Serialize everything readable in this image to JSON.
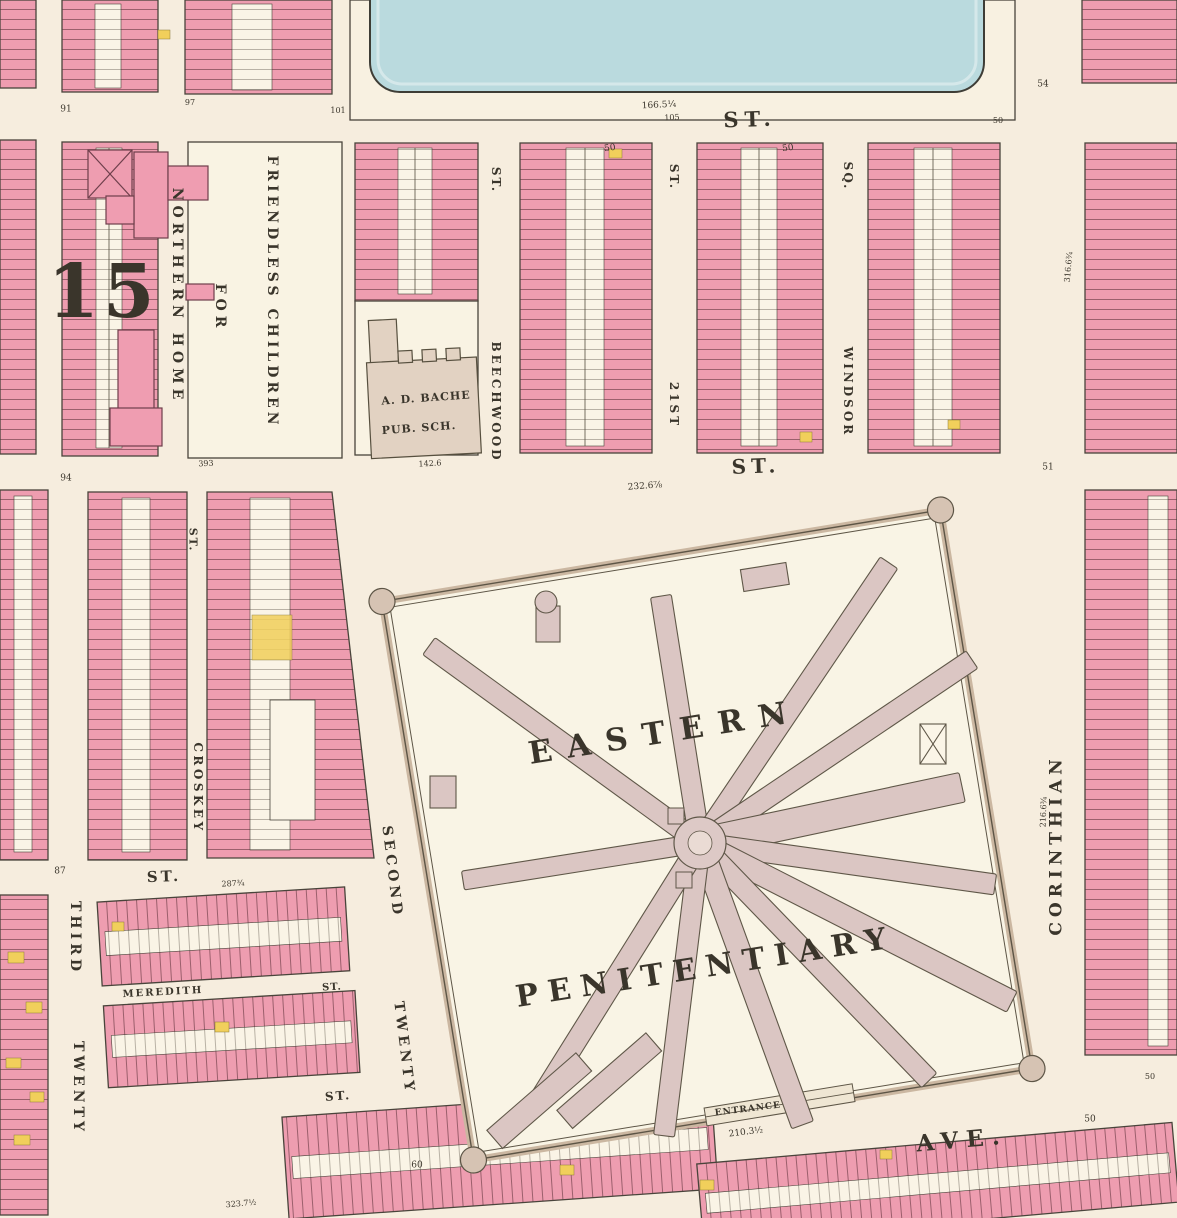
{
  "map": {
    "sheet_type": "property-atlas-plate",
    "plate_number": "15",
    "colors": {
      "paper": "#f6edde",
      "block_ground": "#f8f1e1",
      "house_pink": "#ee9db0",
      "house_white": "#faf4e6",
      "house_yellow": "#f1cf5b",
      "water": "#badade",
      "wall_tan": "#cbb7a1",
      "wing_mauve": "#dbc6c3",
      "outline": "#49443b",
      "ink": "#3a352b"
    },
    "labels": [
      {
        "n": "plate-number",
        "t": "15",
        "x": 103,
        "y": 292,
        "r": 0,
        "s": 74,
        "ls": 4,
        "w": 700
      },
      {
        "n": "street-st-top",
        "t": "ST.",
        "x": 750,
        "y": 119,
        "r": -2,
        "s": 21,
        "ls": 6,
        "w": 700
      },
      {
        "n": "dim-top-1",
        "t": "166.5¼",
        "x": 659,
        "y": 106,
        "r": -3,
        "s": 9,
        "w": 400
      },
      {
        "n": "dim-top-2",
        "t": "105",
        "x": 672,
        "y": 118,
        "r": -3,
        "s": 8,
        "w": 400
      },
      {
        "n": "dim-top-3",
        "t": "50",
        "x": 998,
        "y": 121,
        "r": 0,
        "s": 8,
        "w": 400
      },
      {
        "n": "num-54",
        "t": "54",
        "x": 1043,
        "y": 85,
        "r": 0,
        "s": 9,
        "w": 400
      },
      {
        "n": "num-91",
        "t": "91",
        "x": 66,
        "y": 110,
        "r": 0,
        "s": 9,
        "w": 400
      },
      {
        "n": "num-101",
        "t": "101",
        "x": 338,
        "y": 111,
        "r": 0,
        "s": 8,
        "w": 400
      },
      {
        "n": "num-97",
        "t": "97",
        "x": 190,
        "y": 103,
        "r": 0,
        "s": 8,
        "w": 400
      },
      {
        "n": "street-beechwood-st",
        "t": "ST.",
        "x": 496,
        "y": 180,
        "r": 90,
        "s": 12,
        "ls": 2,
        "w": 700
      },
      {
        "n": "street-beechwood",
        "t": "BEECHWOOD",
        "x": 496,
        "y": 402,
        "r": 90,
        "s": 12,
        "ls": 3,
        "w": 700
      },
      {
        "n": "street-21st-st",
        "t": "ST.",
        "x": 674,
        "y": 177,
        "r": 90,
        "s": 12,
        "ls": 2,
        "w": 700
      },
      {
        "n": "street-21st",
        "t": "21ST",
        "x": 674,
        "y": 405,
        "r": 90,
        "s": 12,
        "ls": 3,
        "w": 700
      },
      {
        "n": "street-windsor-sq",
        "t": "SQ.",
        "x": 848,
        "y": 176,
        "r": 90,
        "s": 12,
        "ls": 2,
        "w": 700
      },
      {
        "n": "street-windsor",
        "t": "WINDSOR",
        "x": 848,
        "y": 392,
        "r": 90,
        "s": 12,
        "ls": 3,
        "w": 700
      },
      {
        "n": "institution-northern-home",
        "t": "NORTHERN HOME",
        "x": 177,
        "y": 296,
        "r": 90,
        "s": 14,
        "ls": 5,
        "w": 700
      },
      {
        "n": "institution-for",
        "t": "FOR",
        "x": 220,
        "y": 308,
        "r": 90,
        "s": 14,
        "ls": 5,
        "w": 700
      },
      {
        "n": "institution-friendless-children",
        "t": "FRIENDLESS CHILDREN",
        "x": 272,
        "y": 292,
        "r": 90,
        "s": 14,
        "ls": 4,
        "w": 700
      },
      {
        "n": "school-name",
        "t": "A. D. BACHE",
        "x": 426,
        "y": 398,
        "r": -4,
        "s": 11,
        "ls": 1,
        "w": 700
      },
      {
        "n": "school-type",
        "t": "PUB. SCH.",
        "x": 419,
        "y": 428,
        "r": -4,
        "s": 11,
        "ls": 1,
        "w": 700
      },
      {
        "n": "dim-school",
        "t": "142.6",
        "x": 430,
        "y": 464,
        "r": -3,
        "s": 8,
        "w": 400
      },
      {
        "n": "dim-home-lot",
        "t": "393",
        "x": 206,
        "y": 464,
        "r": -3,
        "s": 8,
        "w": 400
      },
      {
        "n": "street-st-mid",
        "t": "ST.",
        "x": 756,
        "y": 466,
        "r": -2,
        "s": 20,
        "ls": 5,
        "w": 700
      },
      {
        "n": "dim-mid",
        "t": "232.6⅞",
        "x": 645,
        "y": 487,
        "r": -4,
        "s": 9,
        "w": 400
      },
      {
        "n": "num-51",
        "t": "51",
        "x": 1048,
        "y": 468,
        "r": 0,
        "s": 9,
        "w": 400
      },
      {
        "n": "num-94",
        "t": "94",
        "x": 66,
        "y": 479,
        "r": 0,
        "s": 9,
        "w": 400
      },
      {
        "n": "dim-50-a",
        "t": "50",
        "x": 610,
        "y": 149,
        "r": -8,
        "s": 9,
        "w": 400
      },
      {
        "n": "dim-50-b",
        "t": "50",
        "x": 788,
        "y": 149,
        "r": -8,
        "s": 9,
        "w": 400
      },
      {
        "n": "street-croskey-st",
        "t": "ST.",
        "x": 193,
        "y": 540,
        "r": 90,
        "s": 11,
        "ls": 2,
        "w": 700
      },
      {
        "n": "street-croskey",
        "t": "CROSKEY",
        "x": 198,
        "y": 788,
        "r": 90,
        "s": 12,
        "ls": 3.5,
        "w": 700
      },
      {
        "n": "num-87",
        "t": "87",
        "x": 60,
        "y": 872,
        "r": 0,
        "s": 9,
        "w": 400
      },
      {
        "n": "street-st-left",
        "t": "ST.",
        "x": 164,
        "y": 877,
        "r": -2,
        "s": 15,
        "ls": 3,
        "w": 700
      },
      {
        "n": "dim-left-st",
        "t": "287¾",
        "x": 233,
        "y": 884,
        "r": -3,
        "s": 8,
        "w": 400
      },
      {
        "n": "street-twenty-third-word2",
        "t": "THIRD",
        "x": 75,
        "y": 938,
        "r": 90,
        "s": 14,
        "ls": 4,
        "w": 700
      },
      {
        "n": "street-twenty-third-word1",
        "t": "TWENTY",
        "x": 78,
        "y": 1088,
        "r": 90,
        "s": 14,
        "ls": 4,
        "w": 700
      },
      {
        "n": "street-meredith",
        "t": "MEREDITH",
        "x": 163,
        "y": 993,
        "r": -3,
        "s": 10,
        "ls": 2,
        "w": 700
      },
      {
        "n": "street-meredith-st",
        "t": "ST.",
        "x": 332,
        "y": 988,
        "r": -3,
        "s": 10,
        "ls": 1,
        "w": 700
      },
      {
        "n": "street-st-lower",
        "t": "ST.",
        "x": 338,
        "y": 1096,
        "r": -4,
        "s": 12,
        "ls": 2,
        "w": 700
      },
      {
        "n": "street-twenty-second-word2",
        "t": "SECOND",
        "x": 392,
        "y": 872,
        "r": 83,
        "s": 14,
        "ls": 4,
        "w": 700
      },
      {
        "n": "street-twenty-second-word1",
        "t": "TWENTY",
        "x": 404,
        "y": 1048,
        "r": 83,
        "s": 14,
        "ls": 4,
        "w": 700
      },
      {
        "n": "penitentiary-name-1",
        "t": "EASTERN",
        "x": 665,
        "y": 733,
        "r": -9,
        "s": 31,
        "ls": 15,
        "w": 700
      },
      {
        "n": "penitentiary-name-2",
        "t": "PENITENTIARY",
        "x": 706,
        "y": 968,
        "r": -9,
        "s": 30,
        "ls": 10,
        "w": 700
      },
      {
        "n": "penitentiary-entrance",
        "t": "ENTRANCE",
        "x": 748,
        "y": 1110,
        "r": -7,
        "s": 9,
        "ls": 1,
        "w": 700
      },
      {
        "n": "dim-entrance",
        "t": "210.3½",
        "x": 746,
        "y": 1133,
        "r": -7,
        "s": 9,
        "w": 400
      },
      {
        "n": "num-60",
        "t": "60",
        "x": 417,
        "y": 1166,
        "r": 0,
        "s": 9,
        "w": 400
      },
      {
        "n": "street-corinthian",
        "t": "CORINTHIAN",
        "x": 1057,
        "y": 845,
        "r": -90,
        "s": 17,
        "ls": 5,
        "w": 700
      },
      {
        "n": "dim-corinthian-1",
        "t": "316.6¾",
        "x": 1069,
        "y": 267,
        "r": -85,
        "s": 8,
        "w": 400
      },
      {
        "n": "dim-corinthian-2",
        "t": "216.6¾",
        "x": 1044,
        "y": 812,
        "r": -88,
        "s": 8,
        "w": 400
      },
      {
        "n": "street-ave",
        "t": "AVE.",
        "x": 962,
        "y": 1140,
        "r": -5,
        "s": 23,
        "ls": 8,
        "w": 700
      },
      {
        "n": "dim-ave-1",
        "t": "50",
        "x": 1090,
        "y": 1120,
        "r": 0,
        "s": 9,
        "w": 400
      },
      {
        "n": "dim-ave-2",
        "t": "50",
        "x": 1150,
        "y": 1077,
        "r": 0,
        "s": 8,
        "w": 400
      },
      {
        "n": "dim-bottom",
        "t": "323.7½",
        "x": 241,
        "y": 1204,
        "r": -5,
        "s": 8,
        "w": 400
      }
    ],
    "penitentiary": {
      "center": {
        "x": 700,
        "y": 843
      },
      "hub_radius": 26,
      "wings": [
        {
          "a": 144,
          "len": 335,
          "w": 21
        },
        {
          "a": 99,
          "len": 250,
          "w": 21
        },
        {
          "a": 56,
          "len": 338,
          "w": 21
        },
        {
          "a": 34,
          "len": 328,
          "w": 21
        },
        {
          "a": 12,
          "len": 268,
          "w": 30
        },
        {
          "a": -8,
          "len": 298,
          "w": 21
        },
        {
          "a": -27,
          "len": 350,
          "w": 23
        },
        {
          "a": -46,
          "len": 330,
          "w": 21
        },
        {
          "a": -70,
          "len": 300,
          "w": 23
        },
        {
          "a": -97,
          "len": 295,
          "w": 21
        },
        {
          "a": -122,
          "len": 310,
          "w": 21
        },
        {
          "a": -171,
          "len": 240,
          "w": 19
        }
      ]
    }
  }
}
